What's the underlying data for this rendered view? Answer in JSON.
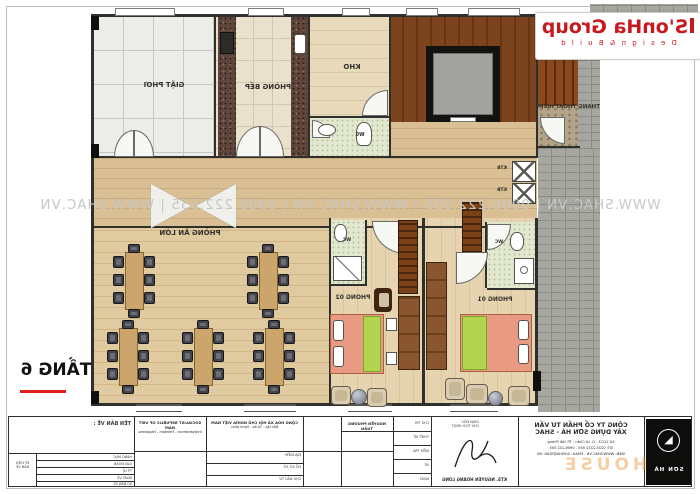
{
  "page": {
    "floor_label": "TẦNG 6",
    "watermark_line": "WWW.SHAC.VN   |   0906.222.555   |   WWW.SHAC.VN   |   0906.222.555   |   WWW.SHAC.VN",
    "orange_watermark": "HOUSE",
    "logo": {
      "name": "S'onHa Group",
      "tagline": "D e s i g n  &  B u i l d"
    },
    "colors": {
      "logo_red": "#c8191f",
      "underline_red": "#e02020",
      "watermark_gray": "#c7c7c7"
    }
  },
  "rooms": {
    "laundry": "GIẶT PHƠI",
    "kitchen": "PHÒNG BẾP",
    "storage": "KHO",
    "wc": "WC",
    "escape_stair": "THANG THOÁT HIỂM",
    "dining": "PHÒNG ĂN LỚN",
    "bedroom2": "PHÒNG 02",
    "bedroom1": "PHÒNG 01",
    "shaft": "KTB"
  },
  "title_block": {
    "drawing_name_label": "TÊN BẢN VẼ :",
    "motto_en1": "SOCIALIST REPUBLIC OF VIET NAM",
    "motto_en2": "Independence - Freedom - Happiness",
    "motto_vn1": "CỘNG HÒA XÃ HỘI CHỦ NGHĨA VIỆT NAM",
    "motto_vn2": "Độc lập - Tự do - Hạnh phúc",
    "investor_name": "NGUYỄN PHƯƠNG TUẤN",
    "architect_name": "KTS. NGUYỄN HOÀNG LONG",
    "company_line1": "CÔNG TY CỔ PHẦN TƯ VẤN",
    "company_line2": "XÂY DỰNG SƠN HÀ - SHAC",
    "company_addr": "Số 12/13 - Q. Lê Chân - TP. Hải Phòng",
    "company_phone": "ĐT: 0225.2222.555 - 0906.222.555",
    "company_web": "WEB: WWW.SHAC.VN - EMAIL: SONHA@SHAC.VN",
    "brand_name": "SƠN HÀ",
    "corner_note1": "KÝ HIỆU",
    "corner_note2": "BẢN VẼ",
    "left_rows": [
      "HẠNG MỤC",
      "GIAI ĐOẠN",
      "TỶ LỆ",
      "NGÀY VẼ",
      "SỐ BẢN VẼ"
    ],
    "mid_rows": [
      "ĐỊA ĐIỂM",
      "HỒ SƠ SỐ",
      "CHỦ ĐẦU TƯ"
    ],
    "right_rows": [
      "CHỦ TRÌ",
      "THIẾT KẾ",
      "KIỂM TRA",
      "VẼ",
      "NGÀY"
    ],
    "sig_header1": "GIÁM ĐỐC",
    "sig_header2": "CHỦ TỊCH HĐQT"
  }
}
